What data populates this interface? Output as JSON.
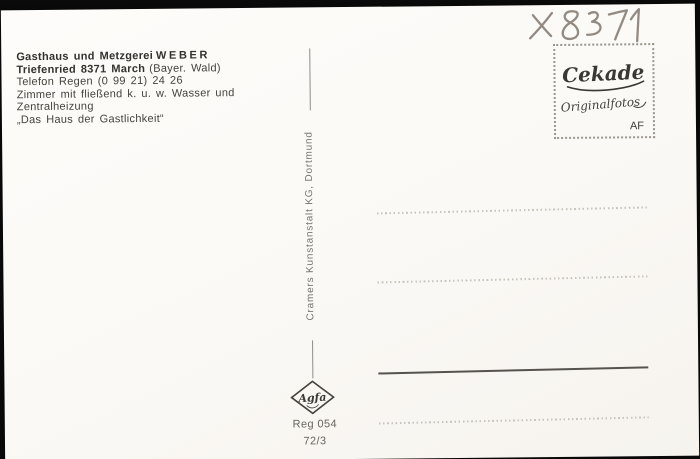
{
  "postcard": {
    "sender_info": {
      "business": "Gasthaus und Metzgerei",
      "owner": "WEBER",
      "address": "Triefenried 8371 March",
      "region": "(Bayer. Wald)",
      "phone": "Telefon Regen (0 99 21) 24 26",
      "amenities_line1": "Zimmer mit fließend k. u. w. Wasser und",
      "amenities_line2": "Zentralheizung",
      "slogan": "„Das Haus der Gastlichkeit“"
    },
    "handwritten_code": "x 8371",
    "stamp_box": {
      "brand": "Cekade",
      "product": "Originalfotos",
      "initials": "AF"
    },
    "publisher": "Cramers Kunstanstalt KG, Dortmund",
    "film_brand": "Agfa",
    "registry_number": "Reg 054",
    "series_code": "72/3"
  },
  "colors": {
    "scan_background": "#0a0a0a",
    "card": "#fcfaf6",
    "ink": "#3a3834",
    "pencil": "#8a8078",
    "light_gray_text": "#787470",
    "solid_line": "#56524d",
    "dotted_line": "#c2bfb8"
  }
}
